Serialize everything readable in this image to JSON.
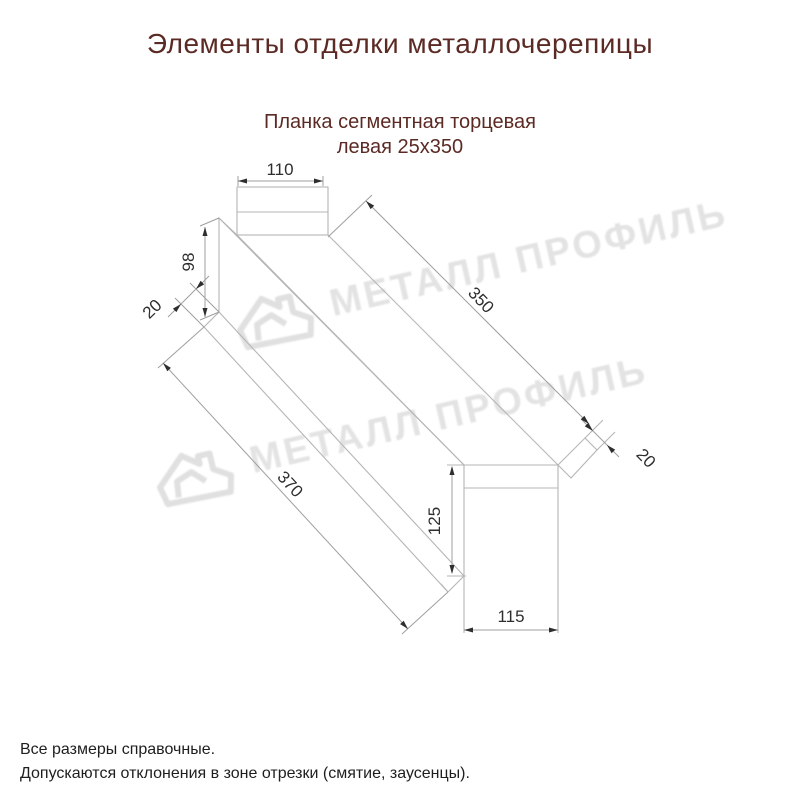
{
  "title": "Элементы отделки металлочерепицы",
  "subtitle": {
    "line1": "Планка сегментная торцевая",
    "line2": "левая 25х350"
  },
  "watermark": {
    "text": "МЕТАЛЛ ПРОФИЛЬ"
  },
  "drawing": {
    "description": "isometric technical drawing of left segmented end trim strip 25x350",
    "dims": {
      "top_flange_width": "110",
      "start_face_height": "98",
      "start_hem": "20",
      "top_length": "350",
      "end_hem": "20",
      "bottom_length": "370",
      "end_face_height": "125",
      "end_face_width": "115"
    }
  },
  "footer": {
    "line1": "Все размеры справочные.",
    "line2": "Допускаются отклонения в зоне отрезки (смятие, заусенцы)."
  },
  "colors": {
    "heading": "#5c2a24",
    "geometry_line": "#b5b5b5",
    "dimension_line": "#9f9f9f",
    "dimension_text": "#2e2e2e",
    "watermark": "#e3e3e3",
    "footer_text": "#1e1e1e",
    "background": "#ffffff"
  }
}
